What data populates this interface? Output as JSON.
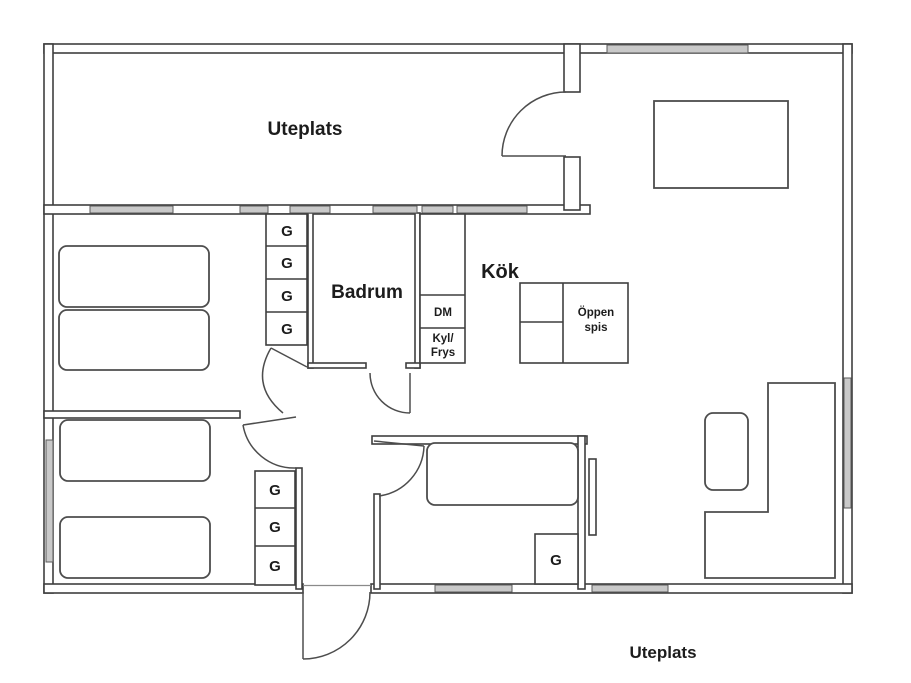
{
  "labels": {
    "patio_top": "Uteplats",
    "patio_bottom": "Uteplats",
    "bathroom": "Badrum",
    "kitchen": "Kök",
    "fireplace_line1": "Öppen",
    "fireplace_line2": "spis",
    "dishwasher": "DM",
    "fridge_line1": "Kyl/",
    "fridge_line2": "Frys",
    "wardrobe": "G"
  },
  "wardrobes": {
    "bedroom_top_left_count": 4,
    "bedroom_bottom_left_count": 3,
    "bedroom_bottom_middle_count": 1
  },
  "colors": {
    "wall": "#3f3f3f",
    "furniture": "#4d4d4d",
    "window_fill": "#c9c9c9",
    "text": "#1c1c1c",
    "background": "#ffffff"
  }
}
